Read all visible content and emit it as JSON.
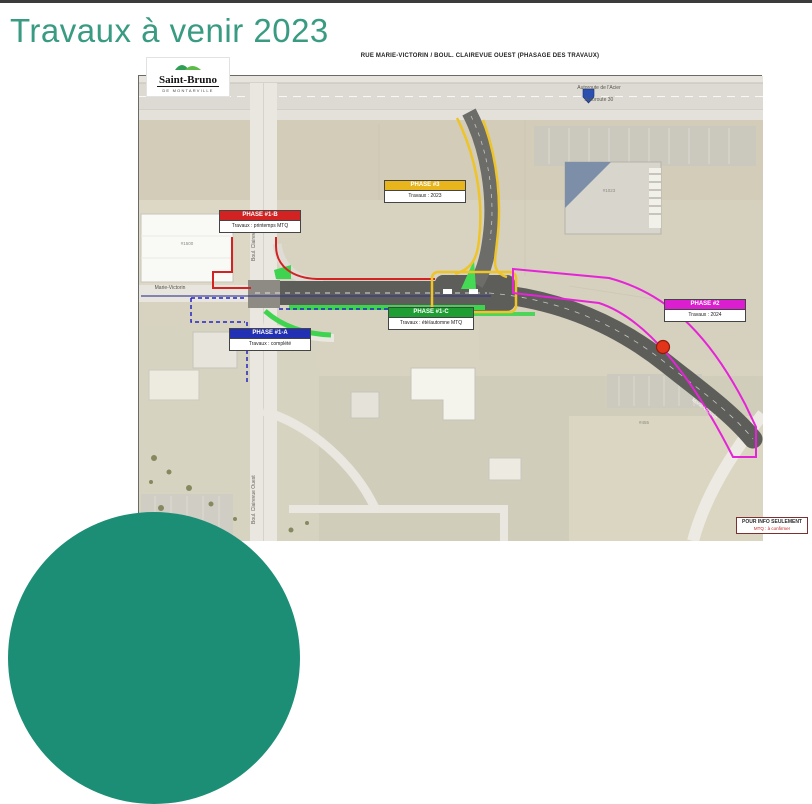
{
  "colors": {
    "title_teal": "#389b82",
    "dome_teal": "#1b8e75",
    "phase_blue": "#2230b4",
    "phase_red": "#d32222",
    "phase_green": "#1f9e33",
    "phase_pink": "#db1ed0",
    "phase_yellow": "#e9b51c"
  },
  "slide": {
    "title": "Travaux à venir 2023"
  },
  "map": {
    "header": "RUE MARIE-VICTORIN / BOUL. CLAIREVUE OUEST  (PHASAGE DES TRAVAUX)",
    "logo": {
      "city": "Saint-Bruno",
      "subtitle": "DE MONTARVILLE"
    },
    "streets": {
      "marie_victorin_west": "Marie-Victorin",
      "marie_victorin_mid": "Marie-Victorin",
      "marie_victorin_southeast": "Marie-Victorin",
      "clairevue_north": "Boul. Clairevue Ouest",
      "clairevue_south": "Boul. Clairevue Ouest",
      "autoroute_name": "Autoroute de l'Acier",
      "autoroute_number": "Autoroute 30"
    },
    "buildings": {
      "left": "#1500",
      "top_right": "#1023",
      "bottom_right": "#455"
    },
    "phases": [
      {
        "title": "PHASE #1-A",
        "subtitle": "Travaux : complété",
        "color": "#2230b4"
      },
      {
        "title": "PHASE #1-B",
        "subtitle": "Travaux : printemps MTQ",
        "color": "#d32222"
      },
      {
        "title": "PHASE #1-C",
        "subtitle": "Travaux : été/automne MTQ",
        "color": "#1f9e33"
      },
      {
        "title": "PHASE #2",
        "subtitle": "Travaux : 2024",
        "color": "#db1ed0"
      },
      {
        "title": "PHASE #3",
        "subtitle": "Travaux : 2023",
        "color": "#e9b51c"
      }
    ],
    "info_box": {
      "line1": "POUR INFO SEULEMENT",
      "line2": "MTQ : à confirmer"
    }
  }
}
